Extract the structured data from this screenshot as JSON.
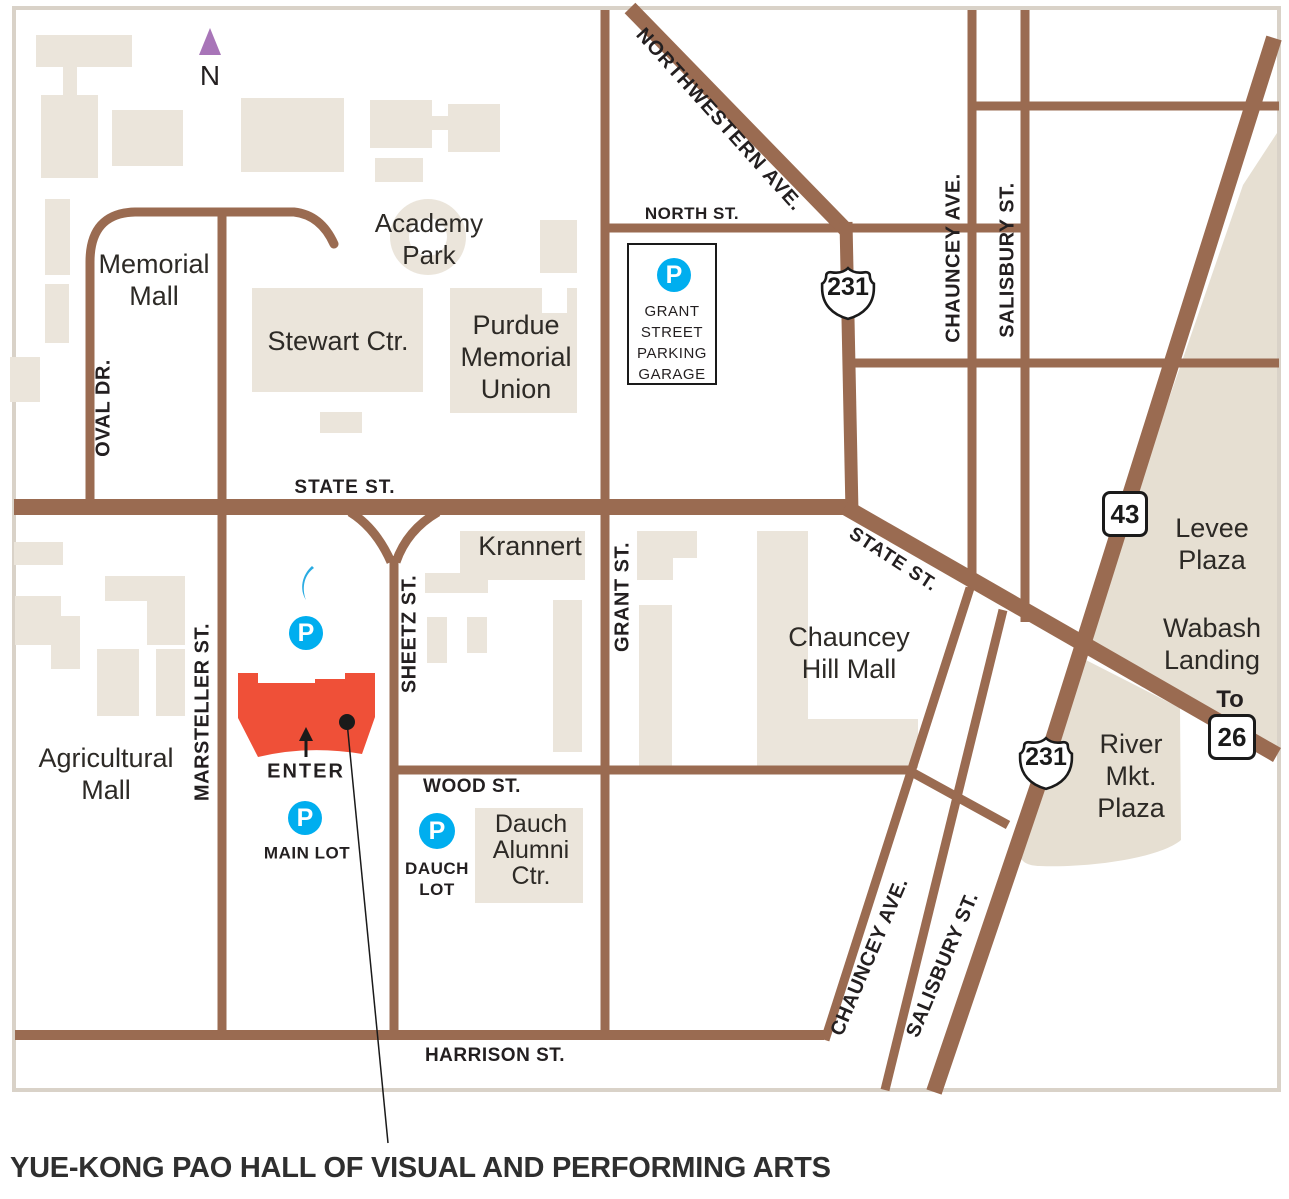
{
  "title": "YUE-KONG PAO HALL OF VISUAL AND PERFORMING ARTS",
  "compass": {
    "n": "N"
  },
  "enter_label": "ENTER",
  "streets": {
    "state_main": "STATE ST.",
    "state_diag": "STATE ST.",
    "north": "NORTH ST.",
    "wood": "WOOD ST.",
    "harrison": "HARRISON ST.",
    "oval": "OVAL DR.",
    "marsteller": "MARSTELLER ST.",
    "sheetz": "SHEETZ ST.",
    "grant": "GRANT ST.",
    "northwestern": "NORTHWESTERN AVE.",
    "chauncey_top": "CHAUNCEY AVE.",
    "chauncey_bottom": "CHAUNCEY AVE.",
    "salisbury_top": "SALISBURY ST.",
    "salisbury_bottom": "SALISBURY ST."
  },
  "places": {
    "memorial_mall": [
      "Memorial",
      "Mall"
    ],
    "academy_park": [
      "Academy",
      "Park"
    ],
    "stewart": "Stewart Ctr.",
    "purdue_memorial_union": [
      "Purdue",
      "Memorial",
      "Union"
    ],
    "krannert": "Krannert",
    "chauncey_hill_mall": [
      "Chauncey",
      "Hill Mall"
    ],
    "agricultural_mall": [
      "Agricultural",
      "Mall"
    ],
    "levee_plaza": [
      "Levee",
      "Plaza"
    ],
    "wabash_landing": [
      "Wabash",
      "Landing"
    ],
    "river_mkt_plaza": [
      "River",
      "Mkt.",
      "Plaza"
    ],
    "dauch_alumni_ctr": [
      "Dauch",
      "Alumni",
      "Ctr."
    ]
  },
  "parking": {
    "p_letter": "P",
    "garage": [
      "GRANT",
      "STREET",
      "PARKING",
      "GARAGE"
    ],
    "main_lot": "MAIN LOT",
    "dauch_lot": [
      "DAUCH",
      "LOT"
    ]
  },
  "shields": {
    "us231_north": "231",
    "us231_south": "231",
    "route43": "43",
    "route26": "26",
    "to_label": "To"
  },
  "colors": {
    "road": "#9A6B51",
    "building": "#EBE5DB",
    "plaza": "#E6DFD2",
    "highlight_building": "#EF5038",
    "parking_blue": "#00AEEF",
    "compass_purple": "#A875B8",
    "map_border": "#D9D2C8",
    "text": "#231F20"
  }
}
